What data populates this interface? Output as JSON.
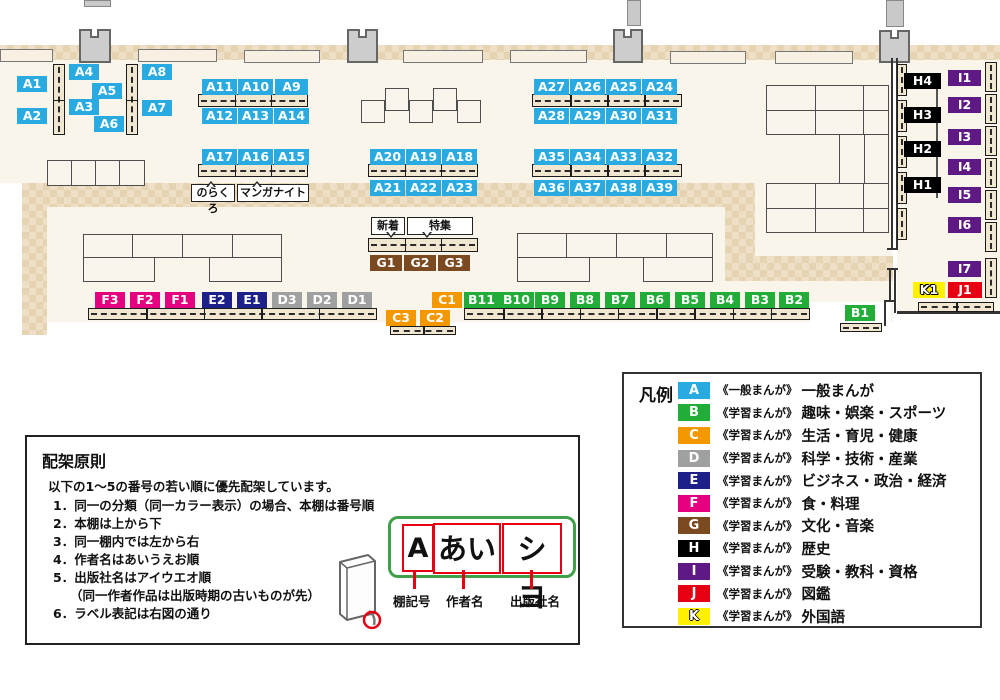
{
  "map": {
    "cat_colors": {
      "A": "#29abe2",
      "B": "#22ac38",
      "C": "#f39800",
      "D": "#9fa0a0",
      "E": "#1d2088",
      "F": "#e4007f",
      "G": "#7b4a21",
      "H": "#000000",
      "I": "#5f1985",
      "J": "#e60012",
      "K": "#fff100"
    },
    "labels": [
      [
        "A1",
        17,
        76,
        "A"
      ],
      [
        "A2",
        17,
        108,
        "A"
      ],
      [
        "A4",
        69,
        64,
        "A"
      ],
      [
        "A5",
        92,
        83,
        "A"
      ],
      [
        "A3",
        69,
        99,
        "A"
      ],
      [
        "A6",
        94,
        116,
        "A"
      ],
      [
        "A8",
        142,
        64,
        "A"
      ],
      [
        "A7",
        142,
        100,
        "A"
      ],
      [
        "A11",
        202,
        79,
        "A",
        35
      ],
      [
        "A10",
        238,
        79,
        "A",
        35
      ],
      [
        "A9",
        275,
        79,
        "A",
        33
      ],
      [
        "A12",
        202,
        108,
        "A",
        35
      ],
      [
        "A13",
        238,
        108,
        "A",
        35
      ],
      [
        "A14",
        274,
        108,
        "A",
        35
      ],
      [
        "A17",
        202,
        149,
        "A",
        35
      ],
      [
        "A16",
        238,
        149,
        "A",
        35
      ],
      [
        "A15",
        274,
        149,
        "A",
        35
      ],
      [
        "A20",
        370,
        149,
        "A",
        35
      ],
      [
        "A19",
        406,
        149,
        "A",
        35
      ],
      [
        "A18",
        442,
        149,
        "A",
        35
      ],
      [
        "A21",
        370,
        180,
        "A",
        35
      ],
      [
        "A22",
        406,
        180,
        "A",
        35
      ],
      [
        "A23",
        442,
        180,
        "A",
        35
      ],
      [
        "A27",
        534,
        79,
        "A",
        35
      ],
      [
        "A26",
        570,
        79,
        "A",
        35
      ],
      [
        "A25",
        606,
        79,
        "A",
        35
      ],
      [
        "A24",
        642,
        79,
        "A",
        35
      ],
      [
        "A28",
        534,
        108,
        "A",
        35
      ],
      [
        "A29",
        570,
        108,
        "A",
        35
      ],
      [
        "A30",
        606,
        108,
        "A",
        35
      ],
      [
        "A31",
        642,
        108,
        "A",
        35
      ],
      [
        "A35",
        534,
        149,
        "A",
        35
      ],
      [
        "A34",
        570,
        149,
        "A",
        35
      ],
      [
        "A33",
        606,
        149,
        "A",
        35
      ],
      [
        "A32",
        642,
        149,
        "A",
        35
      ],
      [
        "A36",
        534,
        180,
        "A",
        35
      ],
      [
        "A37",
        570,
        180,
        "A",
        35
      ],
      [
        "A38",
        606,
        180,
        "A",
        35
      ],
      [
        "A39",
        642,
        180,
        "A",
        35
      ],
      [
        "G1",
        370,
        255,
        "G",
        32
      ],
      [
        "G2",
        404,
        255,
        "G",
        32
      ],
      [
        "G3",
        438,
        255,
        "G",
        32
      ],
      [
        "F3",
        95,
        292,
        "F"
      ],
      [
        "F2",
        130,
        292,
        "F"
      ],
      [
        "F1",
        165,
        292,
        "F"
      ],
      [
        "E2",
        202,
        292,
        "E"
      ],
      [
        "E1",
        237,
        292,
        "E"
      ],
      [
        "D3",
        272,
        292,
        "D"
      ],
      [
        "D2",
        307,
        292,
        "D"
      ],
      [
        "D1",
        342,
        292,
        "D"
      ],
      [
        "C1",
        432,
        292,
        "C"
      ],
      [
        "C3",
        386,
        310,
        "C"
      ],
      [
        "C2",
        420,
        310,
        "C"
      ],
      [
        "B11",
        464,
        292,
        "B",
        35
      ],
      [
        "B10",
        499,
        292,
        "B",
        35
      ],
      [
        "B9",
        535,
        292,
        "B"
      ],
      [
        "B8",
        570,
        292,
        "B"
      ],
      [
        "B7",
        605,
        292,
        "B"
      ],
      [
        "B6",
        640,
        292,
        "B"
      ],
      [
        "B5",
        675,
        292,
        "B"
      ],
      [
        "B4",
        710,
        292,
        "B"
      ],
      [
        "B3",
        745,
        292,
        "B"
      ],
      [
        "B2",
        779,
        292,
        "B"
      ],
      [
        "B1",
        845,
        305,
        "B"
      ],
      [
        "H4",
        904,
        73,
        "H",
        37
      ],
      [
        "H3",
        904,
        107,
        "H",
        37
      ],
      [
        "H2",
        904,
        141,
        "H",
        37
      ],
      [
        "H1",
        904,
        177,
        "H",
        37
      ],
      [
        "I1",
        948,
        70,
        "I",
        33
      ],
      [
        "I2",
        948,
        97,
        "I",
        33
      ],
      [
        "I3",
        948,
        129,
        "I",
        33
      ],
      [
        "I4",
        948,
        159,
        "I",
        33
      ],
      [
        "I5",
        948,
        187,
        "I",
        33
      ],
      [
        "I6",
        948,
        217,
        "I",
        33
      ],
      [
        "I7",
        948,
        261,
        "I",
        33
      ],
      [
        "K1",
        913,
        282,
        "K",
        32
      ],
      [
        "J1",
        948,
        282,
        "J",
        34
      ]
    ],
    "tags": [
      {
        "t": "のらくろ",
        "x": 191,
        "y": 184,
        "w": 44,
        "dir": "up"
      },
      {
        "t": "マンガナイト",
        "x": 237,
        "y": 184,
        "w": 72,
        "dir": "up"
      },
      {
        "t": "新着",
        "x": 371,
        "y": 217,
        "w": 34,
        "dir": "down"
      },
      {
        "t": "特集",
        "x": 407,
        "y": 217,
        "w": 66,
        "dir": "down"
      }
    ]
  },
  "legend": {
    "title": "凡例",
    "items": [
      {
        "code": "A",
        "color": "#29abe2",
        "kind": "《一般まんが》",
        "label": "一般まんが"
      },
      {
        "code": "B",
        "color": "#22ac38",
        "kind": "《学習まんが》",
        "label": "趣味・娯楽・スポーツ"
      },
      {
        "code": "C",
        "color": "#f39800",
        "kind": "《学習まんが》",
        "label": "生活・育児・健康"
      },
      {
        "code": "D",
        "color": "#9fa0a0",
        "kind": "《学習まんが》",
        "label": "科学・技術・産業"
      },
      {
        "code": "E",
        "color": "#1d2088",
        "kind": "《学習まんが》",
        "label": "ビジネス・政治・経済"
      },
      {
        "code": "F",
        "color": "#e4007f",
        "kind": "《学習まんが》",
        "label": "食・料理"
      },
      {
        "code": "G",
        "color": "#7b4a21",
        "kind": "《学習まんが》",
        "label": "文化・音楽"
      },
      {
        "code": "H",
        "color": "#000000",
        "kind": "《学習まんが》",
        "label": "歴史"
      },
      {
        "code": "I",
        "color": "#5f1985",
        "kind": "《学習まんが》",
        "label": "受験・教科・資格"
      },
      {
        "code": "J",
        "color": "#e60012",
        "kind": "《学習まんが》",
        "label": "図鑑"
      },
      {
        "code": "K",
        "color": "#fff100",
        "kind": "《学習まんが》",
        "label": "外国語"
      }
    ]
  },
  "principles": {
    "title": "配架原則",
    "intro": "以下の1～5の番号の若い順に優先配架しています。",
    "items": [
      {
        "n": "1．",
        "t": "同一の分類（同一カラー表示）の場合、本棚は番号順",
        "indent": false
      },
      {
        "n": "2．",
        "t": "本棚は上から下",
        "indent": false
      },
      {
        "n": "3．",
        "t": "同一棚内では左から右",
        "indent": false
      },
      {
        "n": "4．",
        "t": "作者名はあいうえお順",
        "indent": false
      },
      {
        "n": "5．",
        "t": "出版社名はアイウエオ順",
        "indent": false
      },
      {
        "n": "",
        "t": "（同一作者作品は出版時期の古いものが先）",
        "indent": true
      },
      {
        "n": "6．",
        "t": "ラベル表記は右図の通り",
        "indent": false
      }
    ]
  },
  "label_diagram": {
    "parts": [
      {
        "char": "A",
        "caption": "棚記号"
      },
      {
        "char": "あい",
        "caption": "作者名"
      },
      {
        "char": "シヨ",
        "caption": "出版社名"
      }
    ]
  }
}
